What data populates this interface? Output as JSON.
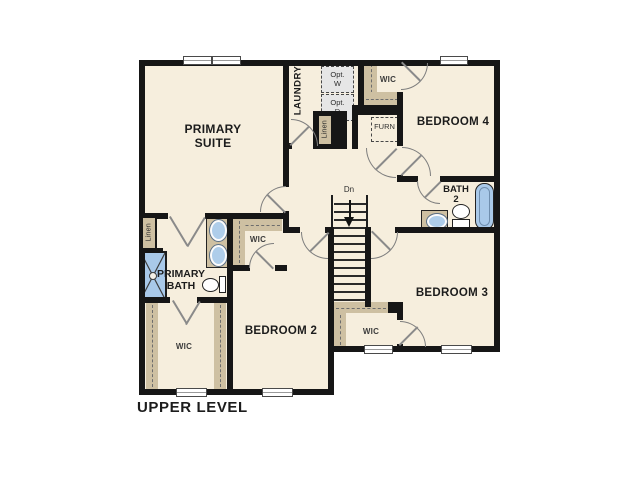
{
  "plan": {
    "level_title": "UPPER LEVEL",
    "rooms": {
      "primary_suite": "PRIMARY\nSUITE",
      "laundry": "LAUNDRY",
      "bedroom_4": "BEDROOM 4",
      "bath_2": "BATH\n2",
      "bedroom_3": "BEDROOM 3",
      "bedroom_2": "BEDROOM 2",
      "primary_bath": "PRIMARY\nBATH",
      "wic_bedroom4": "WIC",
      "wic_bedroom2": "WIC",
      "wic_primary": "WIC",
      "wic_bedroom3": "WIC",
      "linen_laundry": "Linen",
      "linen_primary": "Linen"
    },
    "features": {
      "optional_washer": "Opt.\nW",
      "optional_dryer": "Opt.\nD",
      "furnace": "FURN",
      "stair_direction": "Dn"
    },
    "colors": {
      "background": "#ffffff",
      "floor": "#f6eedd",
      "wall": "#161616",
      "casework_tan": "#cec0a2",
      "fixture_blue": "#a9c9e9",
      "optional_gray": "#e6e6e6"
    }
  }
}
